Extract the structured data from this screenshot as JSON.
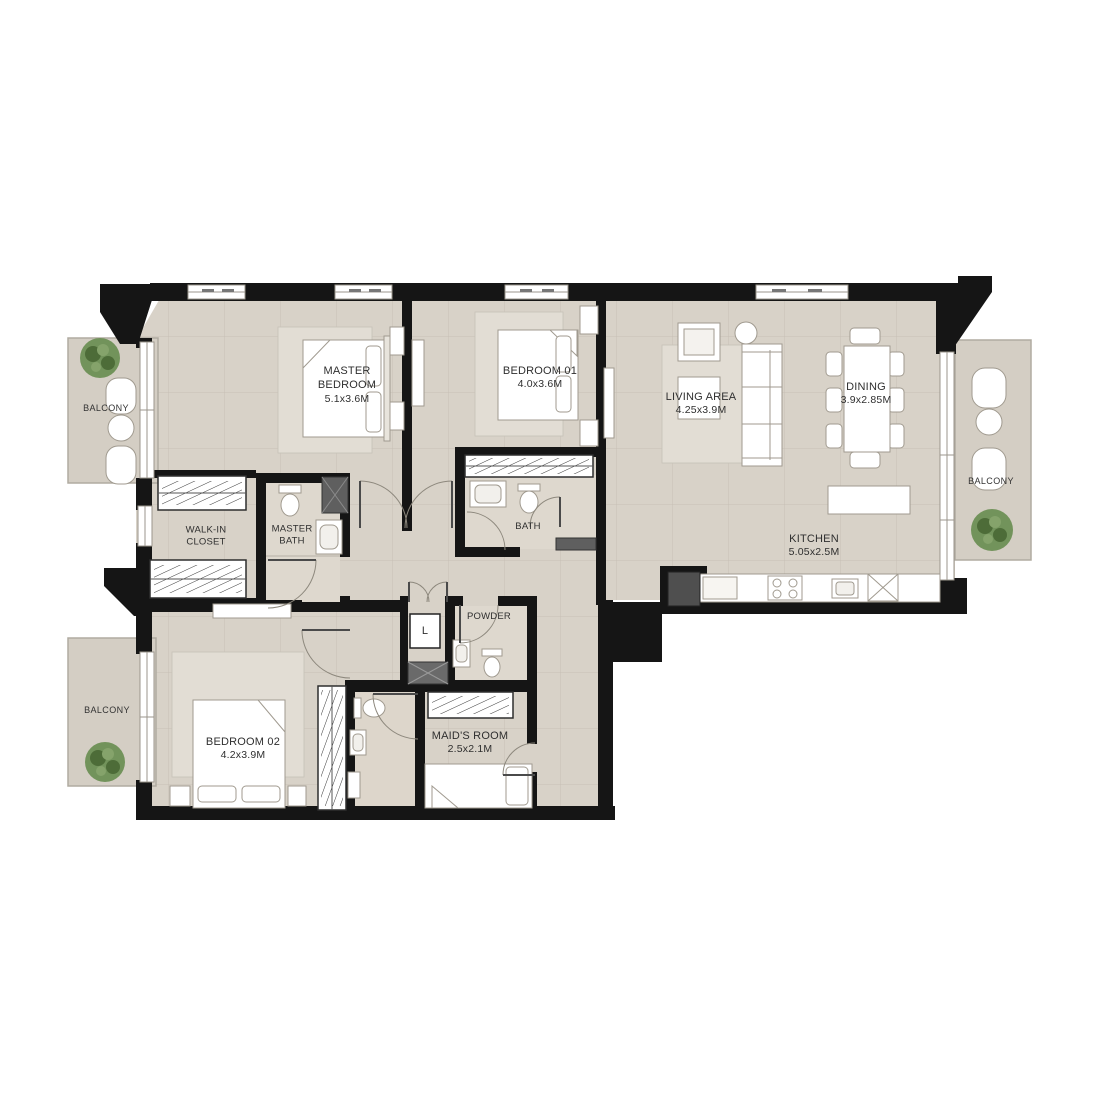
{
  "plan": {
    "title": "Apartment floor plan",
    "rooms": [
      {
        "id": "master_bedroom",
        "name": "MASTER BEDROOM",
        "dims": "5.1x3.6M"
      },
      {
        "id": "bedroom_01",
        "name": "BEDROOM 01",
        "dims": "4.0x3.6M"
      },
      {
        "id": "living_area",
        "name": "LIVING AREA",
        "dims": "4.25x3.9M"
      },
      {
        "id": "dining",
        "name": "DINING",
        "dims": "3.9x2.85M"
      },
      {
        "id": "kitchen",
        "name": "KITCHEN",
        "dims": "5.05x2.5M"
      },
      {
        "id": "walk_in_closet",
        "name": "WALK-IN CLOSET",
        "dims": ""
      },
      {
        "id": "master_bath",
        "name": "MASTER BATH",
        "dims": ""
      },
      {
        "id": "bath",
        "name": "BATH",
        "dims": ""
      },
      {
        "id": "powder",
        "name": "POWDER",
        "dims": ""
      },
      {
        "id": "laundry",
        "name": "L",
        "dims": ""
      },
      {
        "id": "bedroom_02",
        "name": "BEDROOM 02",
        "dims": "4.2x3.9M"
      },
      {
        "id": "maids_room",
        "name": "MAID'S ROOM",
        "dims": "2.5x2.1M"
      }
    ],
    "balconies": [
      {
        "id": "balcony_top_left",
        "label": "BALCONY"
      },
      {
        "id": "balcony_bottom_left",
        "label": "BALCONY"
      },
      {
        "id": "balcony_right",
        "label": "BALCONY"
      }
    ],
    "colors": {
      "wall": "#151515",
      "floor": "#d8d2c8",
      "floor_light": "#e2ddd4",
      "bath_floor": "#ded8ce",
      "balcony_floor": "#d4cec4",
      "shower": "#5f5f5f",
      "plant_green": "#6d8f55",
      "furniture_stroke": "#a09a8f",
      "label_text": "#2f2f2f"
    }
  }
}
